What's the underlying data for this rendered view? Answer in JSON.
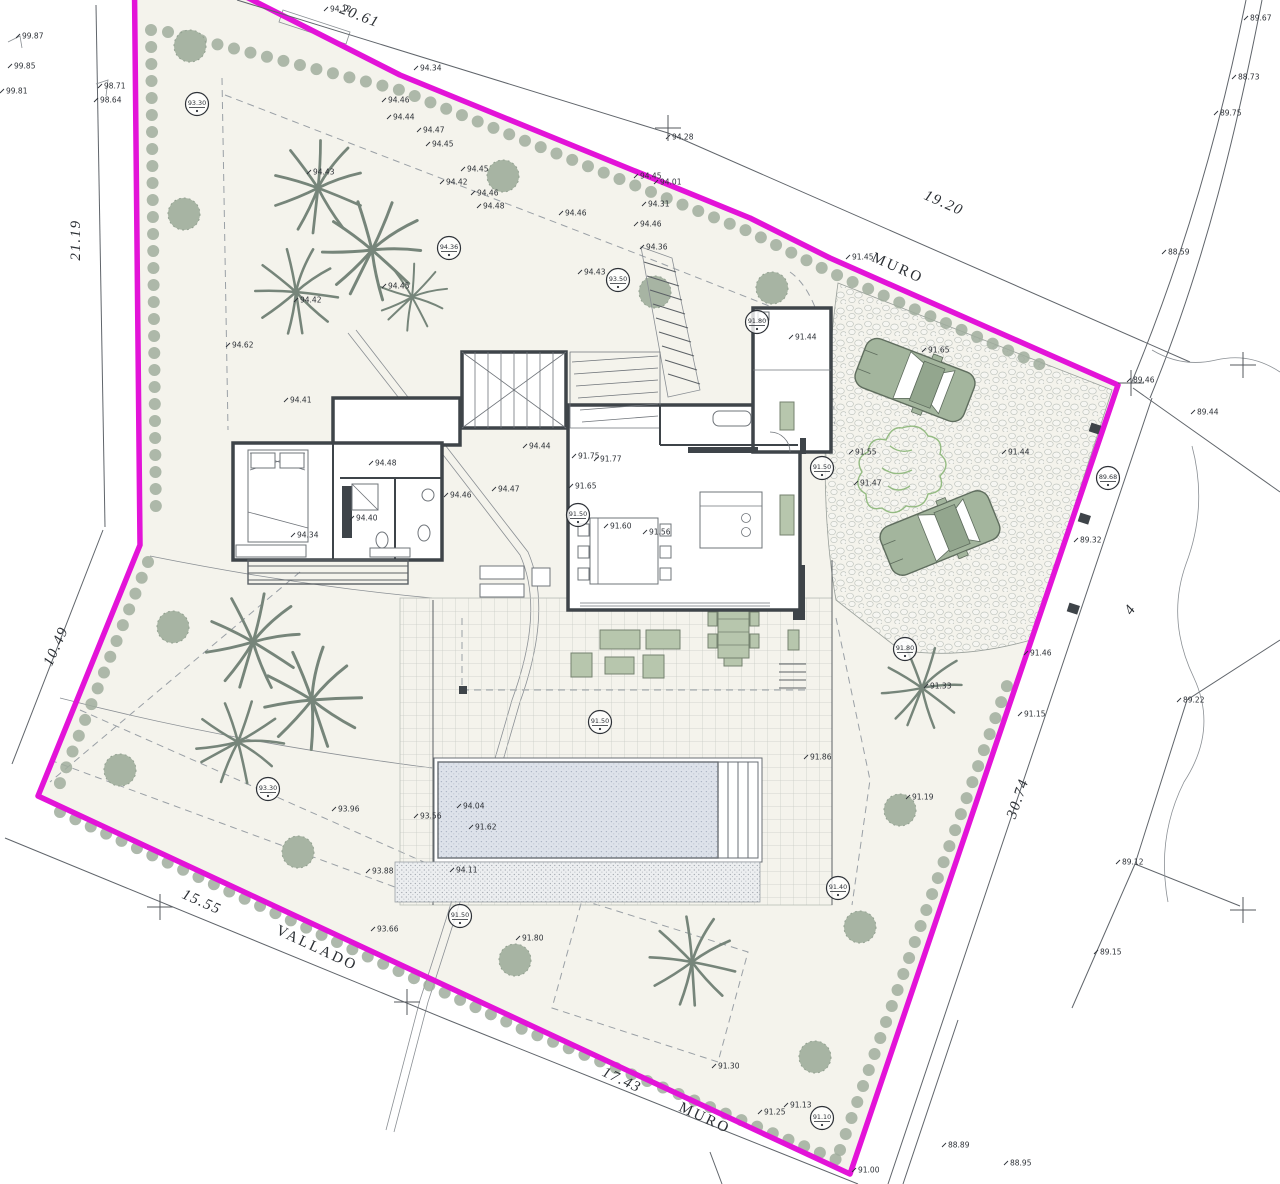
{
  "drawing_title": "site-plan-villa-plot-4",
  "colors": {
    "boundary_magenta": "#e313d8",
    "plot_fill": "#f4f3ec",
    "shrub_green": "#a0ad9d",
    "bush_green": "#a7b4a3",
    "palm_green": "#76857a",
    "car_green": "#a3b59d",
    "pool_water": "#dde2ea",
    "wall_dark": "#3e4449",
    "sketch_tree_green": "#94bb82"
  },
  "plot_number": "4",
  "boundary_names": [
    "MURO",
    "VALLADO"
  ],
  "dimensions": [
    {
      "t": "20.61",
      "x": 358,
      "y": 20,
      "r": 21,
      "w": 0
    },
    {
      "t": "19.20",
      "x": 942,
      "y": 207,
      "r": 24,
      "w": 0
    },
    {
      "t": "MURO",
      "x": 896,
      "y": 272,
      "r": 24,
      "w": 1
    },
    {
      "t": "21.19",
      "x": 80,
      "y": 240,
      "r": -90,
      "w": 0
    },
    {
      "t": "10.49",
      "x": 60,
      "y": 648,
      "r": -66,
      "w": 0
    },
    {
      "t": "15.55",
      "x": 200,
      "y": 906,
      "r": 24,
      "w": 0
    },
    {
      "t": "VALLADO",
      "x": 315,
      "y": 952,
      "r": 25,
      "w": 1
    },
    {
      "t": "17.43",
      "x": 620,
      "y": 1084,
      "r": 25,
      "w": 0
    },
    {
      "t": "MURO",
      "x": 703,
      "y": 1122,
      "r": 25,
      "w": 1
    },
    {
      "t": "30.74",
      "x": 1022,
      "y": 800,
      "r": -71,
      "w": 0
    },
    {
      "t": "4",
      "x": 1134,
      "y": 612,
      "r": -55,
      "w": 0
    }
  ],
  "spot_elevations": [
    {
      "x": 22,
      "y": 36,
      "t": "99.87"
    },
    {
      "x": 14,
      "y": 66,
      "t": "99.85"
    },
    {
      "x": 6,
      "y": 91,
      "t": "99.81"
    },
    {
      "x": 104,
      "y": 86,
      "t": "98.71"
    },
    {
      "x": 100,
      "y": 100,
      "t": "98.64"
    },
    {
      "x": 330,
      "y": 9,
      "t": "94.12"
    },
    {
      "x": 420,
      "y": 68,
      "t": "94.34"
    },
    {
      "x": 388,
      "y": 100,
      "t": "94.46"
    },
    {
      "x": 393,
      "y": 117,
      "t": "94.44"
    },
    {
      "x": 423,
      "y": 130,
      "t": "94.47"
    },
    {
      "x": 432,
      "y": 144,
      "t": "94.45"
    },
    {
      "x": 467,
      "y": 169,
      "t": "94.45"
    },
    {
      "x": 446,
      "y": 182,
      "t": "94.42"
    },
    {
      "x": 477,
      "y": 193,
      "t": "94.46"
    },
    {
      "x": 483,
      "y": 206,
      "t": "94.48"
    },
    {
      "x": 565,
      "y": 213,
      "t": "94.46"
    },
    {
      "x": 640,
      "y": 176,
      "t": "94.45"
    },
    {
      "x": 660,
      "y": 182,
      "t": "94.01"
    },
    {
      "x": 672,
      "y": 137,
      "t": "94.28"
    },
    {
      "x": 648,
      "y": 204,
      "t": "94.31"
    },
    {
      "x": 640,
      "y": 224,
      "t": "94.46"
    },
    {
      "x": 646,
      "y": 247,
      "t": "94.36"
    },
    {
      "x": 584,
      "y": 272,
      "t": "94.43"
    },
    {
      "x": 313,
      "y": 172,
      "t": "94.43"
    },
    {
      "x": 388,
      "y": 286,
      "t": "94.45"
    },
    {
      "x": 300,
      "y": 300,
      "t": "94.42"
    },
    {
      "x": 232,
      "y": 345,
      "t": "94.62"
    },
    {
      "x": 290,
      "y": 400,
      "t": "94.41"
    },
    {
      "x": 852,
      "y": 257,
      "t": "91.45"
    },
    {
      "x": 928,
      "y": 350,
      "t": "91.65"
    },
    {
      "x": 795,
      "y": 337,
      "t": "91.44"
    },
    {
      "x": 855,
      "y": 452,
      "t": "91.55"
    },
    {
      "x": 1008,
      "y": 452,
      "t": "91.44"
    },
    {
      "x": 860,
      "y": 483,
      "t": "91.47"
    },
    {
      "x": 1080,
      "y": 540,
      "t": "89.32"
    },
    {
      "x": 1133,
      "y": 380,
      "t": "89.46"
    },
    {
      "x": 1197,
      "y": 412,
      "t": "89.44"
    },
    {
      "x": 1168,
      "y": 252,
      "t": "88.59"
    },
    {
      "x": 1220,
      "y": 113,
      "t": "89.75"
    },
    {
      "x": 1238,
      "y": 77,
      "t": "88.73"
    },
    {
      "x": 1250,
      "y": 18,
      "t": "89.67"
    },
    {
      "x": 1183,
      "y": 700,
      "t": "89.22"
    },
    {
      "x": 1122,
      "y": 862,
      "t": "89.12"
    },
    {
      "x": 1100,
      "y": 952,
      "t": "89.15"
    },
    {
      "x": 948,
      "y": 1145,
      "t": "88.89"
    },
    {
      "x": 1010,
      "y": 1163,
      "t": "88.95"
    },
    {
      "x": 858,
      "y": 1170,
      "t": "91.00"
    },
    {
      "x": 790,
      "y": 1105,
      "t": "91.13"
    },
    {
      "x": 764,
      "y": 1112,
      "t": "91.25"
    },
    {
      "x": 718,
      "y": 1066,
      "t": "91.30"
    },
    {
      "x": 912,
      "y": 797,
      "t": "91.19"
    },
    {
      "x": 930,
      "y": 686,
      "t": "91.33"
    },
    {
      "x": 1030,
      "y": 653,
      "t": "91.46"
    },
    {
      "x": 1024,
      "y": 714,
      "t": "91.15"
    },
    {
      "x": 375,
      "y": 463,
      "t": "94.48"
    },
    {
      "x": 356,
      "y": 518,
      "t": "94.40"
    },
    {
      "x": 297,
      "y": 535,
      "t": "94.34"
    },
    {
      "x": 450,
      "y": 495,
      "t": "94.46"
    },
    {
      "x": 498,
      "y": 489,
      "t": "94.47"
    },
    {
      "x": 529,
      "y": 446,
      "t": "94.44"
    },
    {
      "x": 578,
      "y": 456,
      "t": "91.75"
    },
    {
      "x": 600,
      "y": 459,
      "t": "91.77"
    },
    {
      "x": 575,
      "y": 486,
      "t": "91.65"
    },
    {
      "x": 610,
      "y": 526,
      "t": "91.60"
    },
    {
      "x": 649,
      "y": 532,
      "t": "91.56"
    },
    {
      "x": 338,
      "y": 809,
      "t": "93.96"
    },
    {
      "x": 420,
      "y": 816,
      "t": "93.56"
    },
    {
      "x": 372,
      "y": 871,
      "t": "93.88"
    },
    {
      "x": 377,
      "y": 929,
      "t": "93.66"
    },
    {
      "x": 522,
      "y": 938,
      "t": "91.80"
    },
    {
      "x": 463,
      "y": 806,
      "t": "94.04"
    },
    {
      "x": 475,
      "y": 827,
      "t": "91.62"
    },
    {
      "x": 456,
      "y": 870,
      "t": "94.11"
    },
    {
      "x": 810,
      "y": 757,
      "t": "91.86"
    }
  ],
  "benchmarks": [
    {
      "x": 197,
      "y": 104,
      "t": "93.30"
    },
    {
      "x": 449,
      "y": 248,
      "t": "94.36"
    },
    {
      "x": 618,
      "y": 280,
      "t": "93.50"
    },
    {
      "x": 757,
      "y": 322,
      "t": "91.80"
    },
    {
      "x": 822,
      "y": 468,
      "t": "91.50"
    },
    {
      "x": 1108,
      "y": 478,
      "t": "89.68"
    },
    {
      "x": 578,
      "y": 515,
      "t": "91.50"
    },
    {
      "x": 600,
      "y": 722,
      "t": "91.50"
    },
    {
      "x": 905,
      "y": 649,
      "t": "91.80"
    },
    {
      "x": 268,
      "y": 789,
      "t": "93.30"
    },
    {
      "x": 460,
      "y": 916,
      "t": "91.50"
    },
    {
      "x": 838,
      "y": 888,
      "t": "91.40"
    },
    {
      "x": 822,
      "y": 1118,
      "t": "91.10"
    }
  ],
  "survey_crosses": [
    {
      "x": 668,
      "y": 128
    },
    {
      "x": 160,
      "y": 907
    },
    {
      "x": 407,
      "y": 1002
    },
    {
      "x": 1243,
      "y": 365
    },
    {
      "x": 1243,
      "y": 910
    },
    {
      "x": 1131,
      "y": 383
    }
  ]
}
